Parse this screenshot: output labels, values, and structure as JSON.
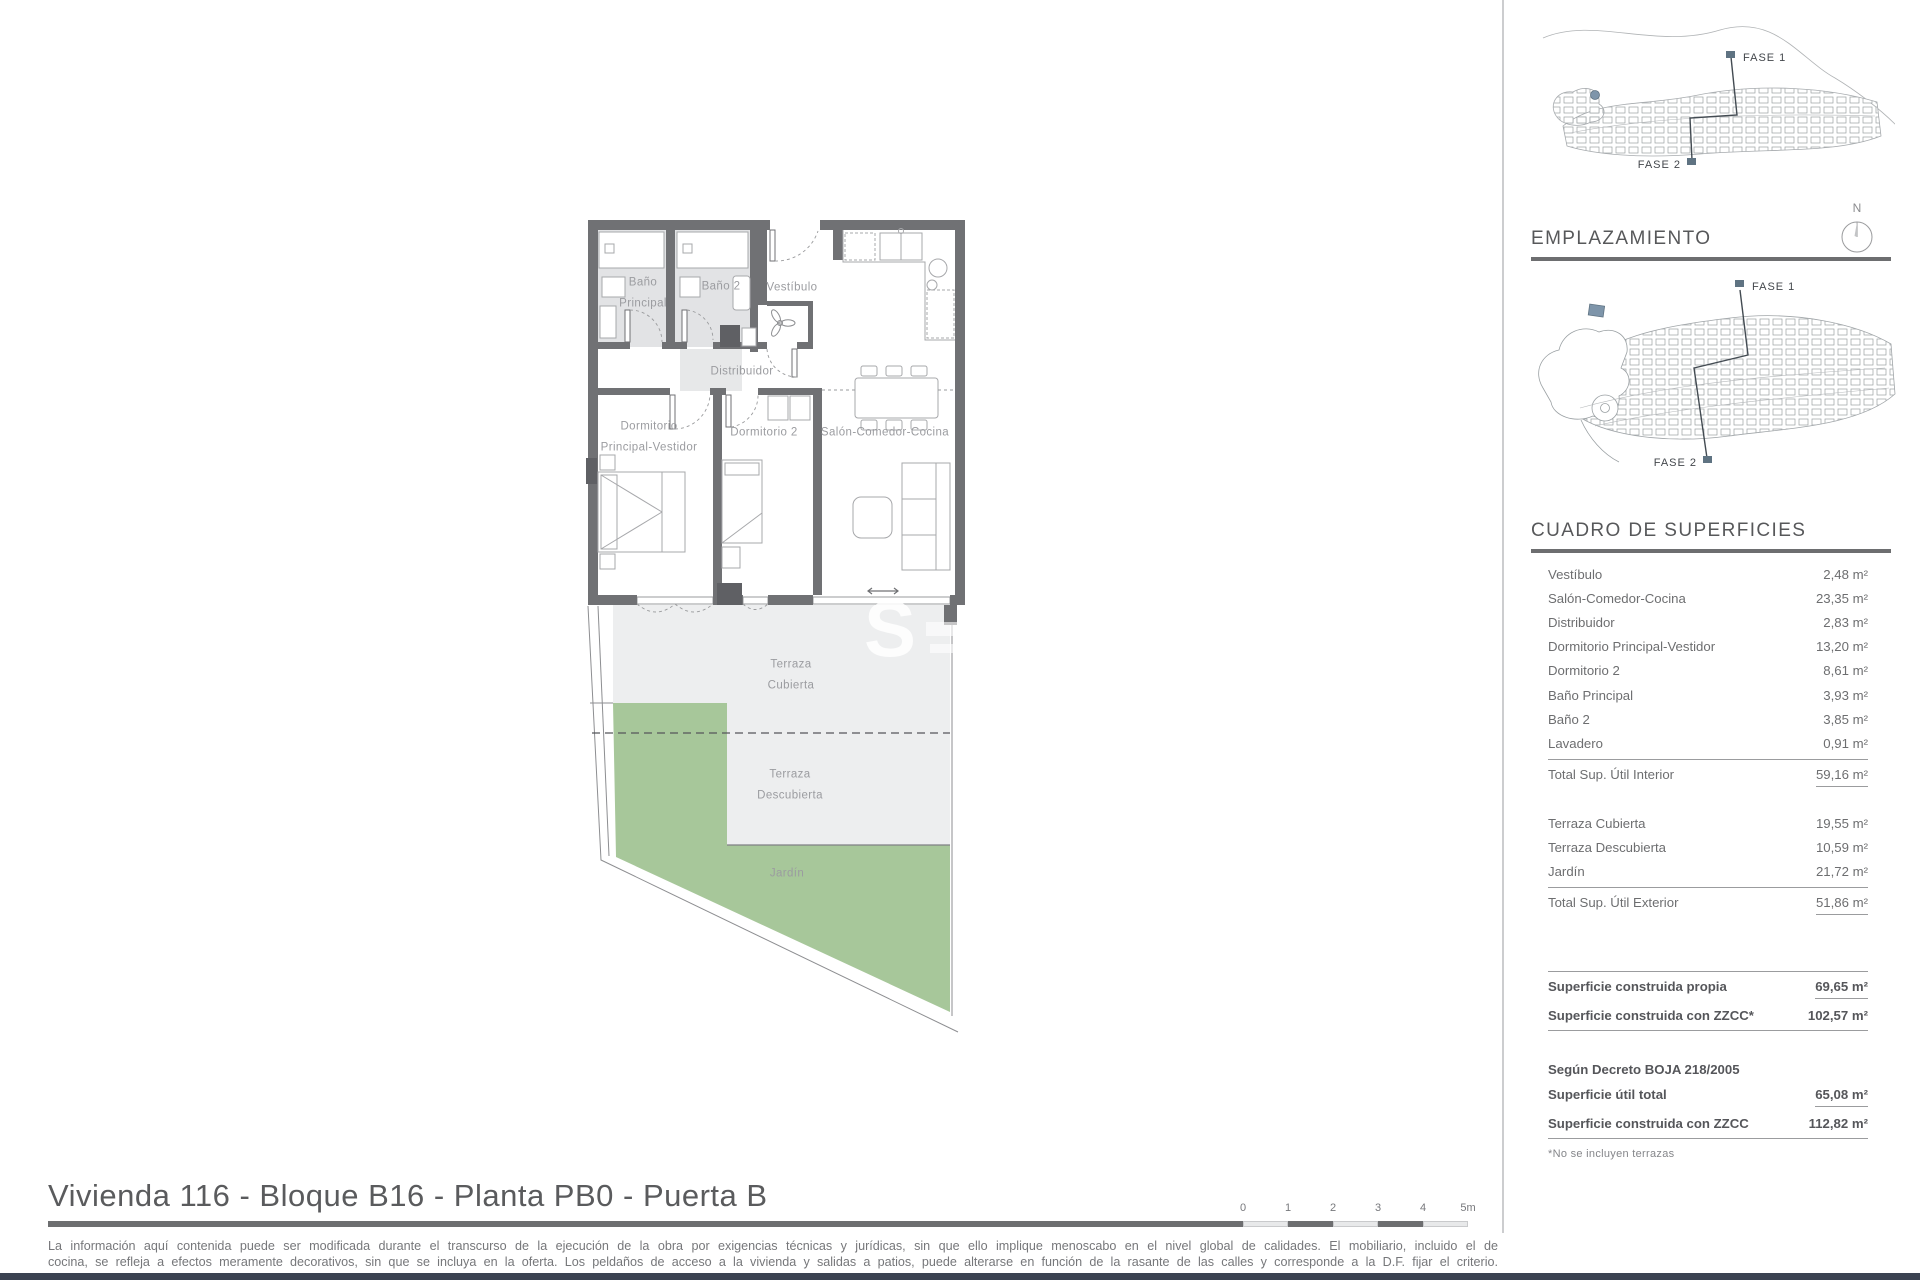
{
  "page": {
    "title": "Vivienda 116 - Bloque B16 - Planta PB0 - Puerta B",
    "disclaimer_line1": "La información aquí contenida puede ser modificada durante el transcurso de la ejecución de la obra por exigencias técnicas y jurídicas, sin que ello implique menoscabo en el nivel global de calidades. El mobiliario, incluido el de",
    "disclaimer_line2": "cocina, se refleja a efectos meramente decorativos, sin que se incluya en la oferta. Los peldaños de acceso a la vivienda y salidas a patios, puede alterarse en función de la rasante de las calles y corresponde a la D.F. fijar el criterio."
  },
  "plan": {
    "watermark": "S",
    "rooms": {
      "bano_principal": "Baño\nPrincipal",
      "bano2": "Baño 2",
      "vestibulo": "Vestíbulo",
      "distribuidor": "Distribuidor",
      "dormitorio_principal": "Dormitorio\nPrincipal-Vestidor",
      "dormitorio2": "Dormitorio 2",
      "salon": "Salón-Comedor-Cocina",
      "terraza_cubierta": "Terraza\nCubierta",
      "terraza_descubierta": "Terraza\nDescubierta",
      "jardin": "Jardín"
    }
  },
  "maps": {
    "emplazamiento_title": "EMPLAZAMIENTO",
    "compass_n": "N",
    "fase1": "FASE 1",
    "fase2": "FASE 2"
  },
  "surfaces": {
    "title": "CUADRO DE SUPERFICIES",
    "interior": [
      {
        "label": "Vestíbulo",
        "value": "2,48 m²"
      },
      {
        "label": "Salón-Comedor-Cocina",
        "value": "23,35 m²"
      },
      {
        "label": "Distribuidor",
        "value": "2,83 m²"
      },
      {
        "label": "Dormitorio Principal-Vestidor",
        "value": "13,20 m²"
      },
      {
        "label": "Dormitorio 2",
        "value": "8,61 m²"
      },
      {
        "label": "Baño Principal",
        "value": "3,93 m²"
      },
      {
        "label": "Baño 2",
        "value": "3,85 m²"
      },
      {
        "label": "Lavadero",
        "value": "0,91 m²"
      }
    ],
    "interior_total": {
      "label": "Total Sup. Útil Interior",
      "value": "59,16 m²"
    },
    "exterior": [
      {
        "label": "Terraza Cubierta",
        "value": "19,55 m²"
      },
      {
        "label": "Terraza Descubierta",
        "value": "10,59 m²"
      },
      {
        "label": "Jardín",
        "value": "21,72 m²"
      }
    ],
    "exterior_total": {
      "label": "Total Sup. Útil Exterior",
      "value": "51,86 m²"
    },
    "built": [
      {
        "label": "Superficie construida propia",
        "value": "69,65 m²"
      },
      {
        "label": "Superficie construida con ZZCC*",
        "value": "102,57 m²"
      }
    ],
    "decree_heading": "Según Decreto BOJA 218/2005",
    "decree": [
      {
        "label": "Superficie útil total",
        "value": "65,08 m²"
      },
      {
        "label": "Superficie construida con ZZCC",
        "value": "112,82 m²"
      }
    ],
    "footnote": "*No se incluyen terrazas"
  },
  "scalebar": {
    "ticks": [
      "0",
      "1",
      "2",
      "3",
      "4",
      "5m"
    ]
  },
  "colors": {
    "wall_gray": "#707174",
    "terrace_gray": "#edeeef",
    "garden_green": "#a7c79a",
    "marker_blue": "#7e95aa",
    "rule_gray": "#6d6e70"
  }
}
